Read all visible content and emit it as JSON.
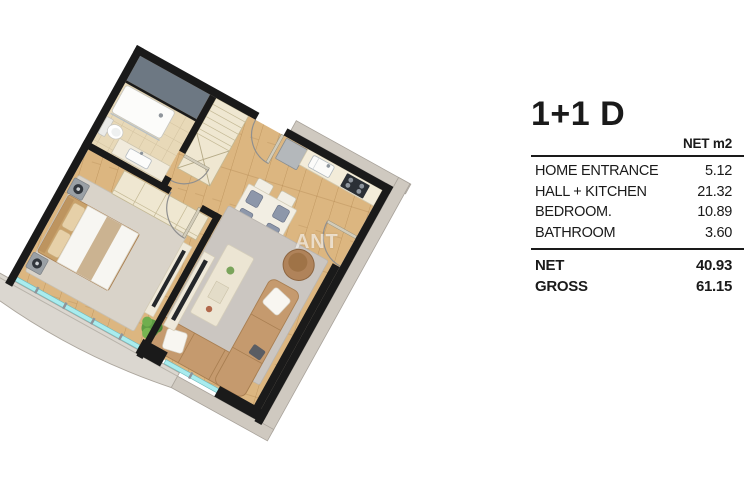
{
  "watermark": "ANT",
  "panel": {
    "title": "1+1 D",
    "unit_header": "NET m2",
    "rows": [
      {
        "label": "HOME ENTRANCE",
        "value": "5.12"
      },
      {
        "label": "HALL + KITCHEN",
        "value": "21.32"
      },
      {
        "label": "BEDROOM.",
        "value": "10.89"
      },
      {
        "label": "BATHROOM",
        "value": "3.60"
      }
    ],
    "totals": [
      {
        "label": "NET",
        "value": "40.93"
      },
      {
        "label": "GROSS",
        "value": "61.15"
      }
    ]
  },
  "colors": {
    "text": "#1a1a1a",
    "wall": "#1a1a1a",
    "wood_floor": "#dcb680",
    "tile_floor": "#e8d9b8",
    "shaft": "#6d7883",
    "exterior_band": "#cfc9c0",
    "balcony_floor": "#dbd7d0",
    "glass": "#a9ecee",
    "rug_living": "#cbc6c1",
    "rug_bedroom": "#d9d3c9",
    "sofa": "#c59a6e",
    "pillow": "#f8f6f1",
    "coffee_table": "#ece5d3",
    "dining_table": "#f2eee3",
    "chair_seat": "#8d97aa",
    "kitchen_counter": "#f3ecd9",
    "fridge": "#b4b8bb",
    "stove": "#2b3036",
    "pouf": "#b0835a",
    "plant": "#68a44c",
    "bed_duvet": "#f7f6f2",
    "bed_accent": "#cbb391",
    "nightstand": "#9aa0a5",
    "wardrobe": "#efe7d1"
  }
}
